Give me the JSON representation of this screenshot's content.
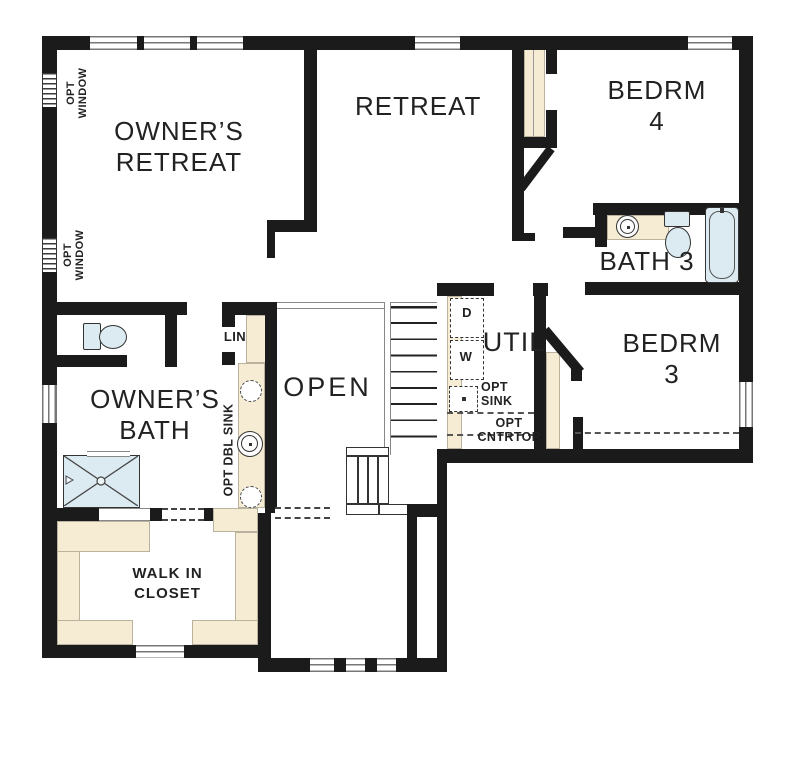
{
  "rooms": {
    "owners_retreat": "OWNER’S\nRETREAT",
    "retreat": "RETREAT",
    "bedrm4": "BEDRM 4",
    "bath3": "BATH 3",
    "bedrm3": "BEDRM 3",
    "util": "UTIL",
    "open": "OPEN",
    "owners_bath": "OWNER’S\nBATH",
    "walk_in_closet": "WALK IN\nCLOSET",
    "lin": "LIN"
  },
  "annotations": {
    "opt_window": "OPT\nWINDOW",
    "opt_dbl_sink": "OPT DBL SINK",
    "dryer": "D",
    "washer": "W",
    "opt_sink": "OPT\nSINK",
    "opt_cntrtop": "OPT\nCNTRTOP"
  },
  "colors": {
    "wall": "#1b1b1b",
    "shelf_fill": "#f6ecd4",
    "fixture_fill": "#dcebf1",
    "text": "#222222",
    "background": "#ffffff"
  }
}
